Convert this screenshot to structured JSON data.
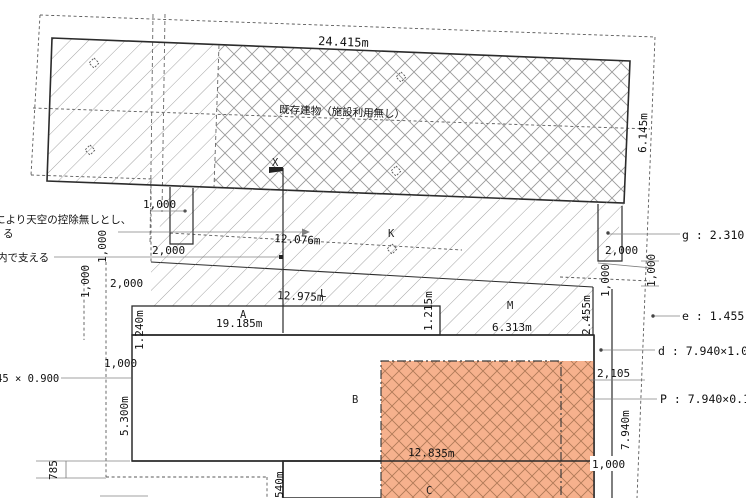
{
  "building_label": "既存建物（施設利用無し）",
  "notes": {
    "l1": "により天空の控除無しとし、",
    "l2": "る",
    "l3": "内で支える"
  },
  "dims": {
    "b_width": "24.415m",
    "b_height": "6.145m",
    "k_line": "12.076m",
    "l_line": "12.975m",
    "a_line": "19.185m",
    "m_line": "6.313m",
    "c_line": "12.835m",
    "a_h": "1.240m",
    "a_h2": "1.215m",
    "m_h": "2.455m",
    "b_h": "5.300m",
    "r_h": "7.940m",
    "c_w": "540m",
    "n785": "785",
    "n2105": "2,105",
    "n1000": "1,000",
    "n2000": "2,000",
    "size_note": "45 × 0.900"
  },
  "regions": {
    "x": "X",
    "k": "K",
    "l": "L",
    "a": "A",
    "m": "M",
    "b": "B",
    "c": "C"
  },
  "callouts": {
    "g": "g : 2.310 ×",
    "e": "e : 1.455 ×",
    "d": "d : 7.940×1.00",
    "p": "P : 7.940×0.10"
  },
  "colors": {
    "plan_orange": "#f6b18d",
    "orange_hatch_line": "#bb8160",
    "grey_hatch_line": "#9a9a9a",
    "outline": "#2b2b2b",
    "dim_grey": "#808080",
    "boundary_dash": "#5a5a5a"
  }
}
